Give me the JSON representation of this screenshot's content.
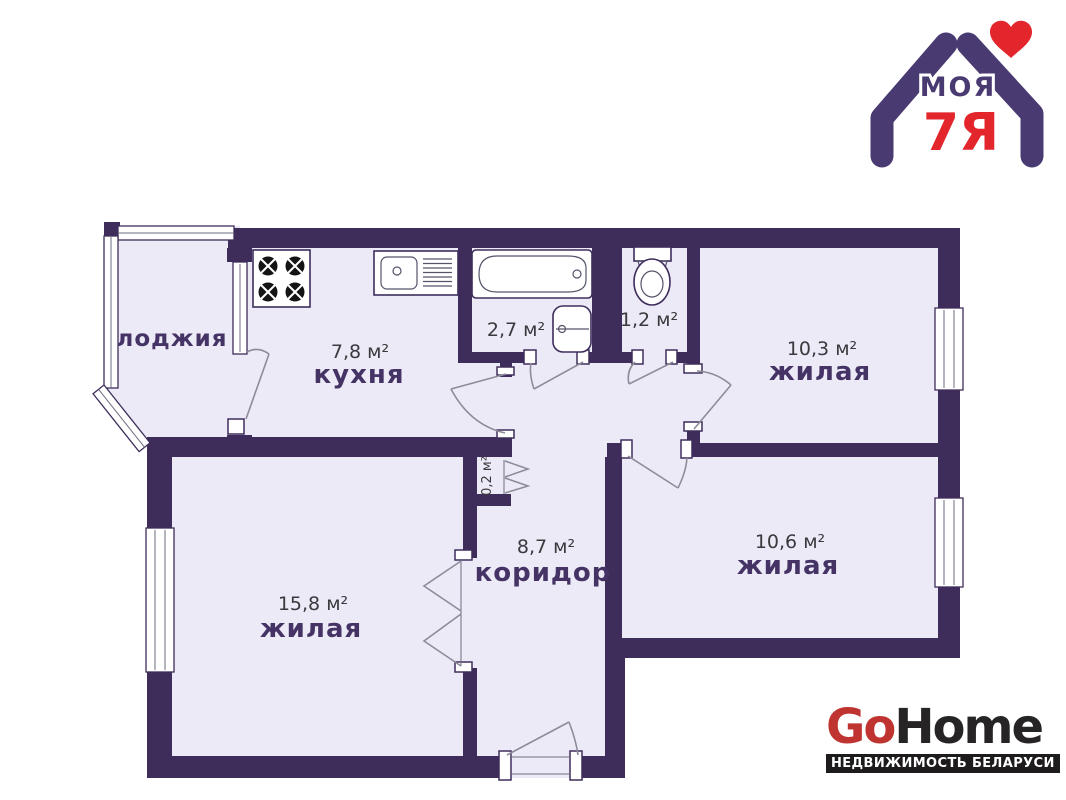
{
  "logo_moya7ya": {
    "word": "МОЯ",
    "family": "7Я"
  },
  "logo_gohome": {
    "go": "Go",
    "home": "Home",
    "tagline": "НЕДВИЖИМОСТЬ БЕЛАРУСИ"
  },
  "plan": {
    "rooms": [
      {
        "id": "loggia",
        "label": "лоджия",
        "area": ""
      },
      {
        "id": "kitchen",
        "label": "кухня",
        "area": "7,8 м²"
      },
      {
        "id": "bathroom",
        "label": "",
        "area": "2,7 м²"
      },
      {
        "id": "wc",
        "label": "",
        "area": "1,2 м²"
      },
      {
        "id": "living-1",
        "label": "жилая",
        "area": "10,3 м²"
      },
      {
        "id": "closet",
        "label": "",
        "area": "0,2 м²"
      },
      {
        "id": "hallway",
        "label": "коридор",
        "area": "8,7 м²"
      },
      {
        "id": "living-2",
        "label": "жилая",
        "area": "15,8 м²"
      },
      {
        "id": "living-3",
        "label": "жилая",
        "area": "10,6 м²"
      }
    ],
    "colors": {
      "wall": "#3e2d5b",
      "floor": "#eceaf6",
      "room_label": "#453366",
      "area_text": "#3b393d",
      "logo_purple": "#4a3a72",
      "logo_red": "#e2262c",
      "gohome_red": "#bf3430",
      "gohome_dark": "#272425",
      "tagline_bg": "#1d1b1b"
    }
  }
}
